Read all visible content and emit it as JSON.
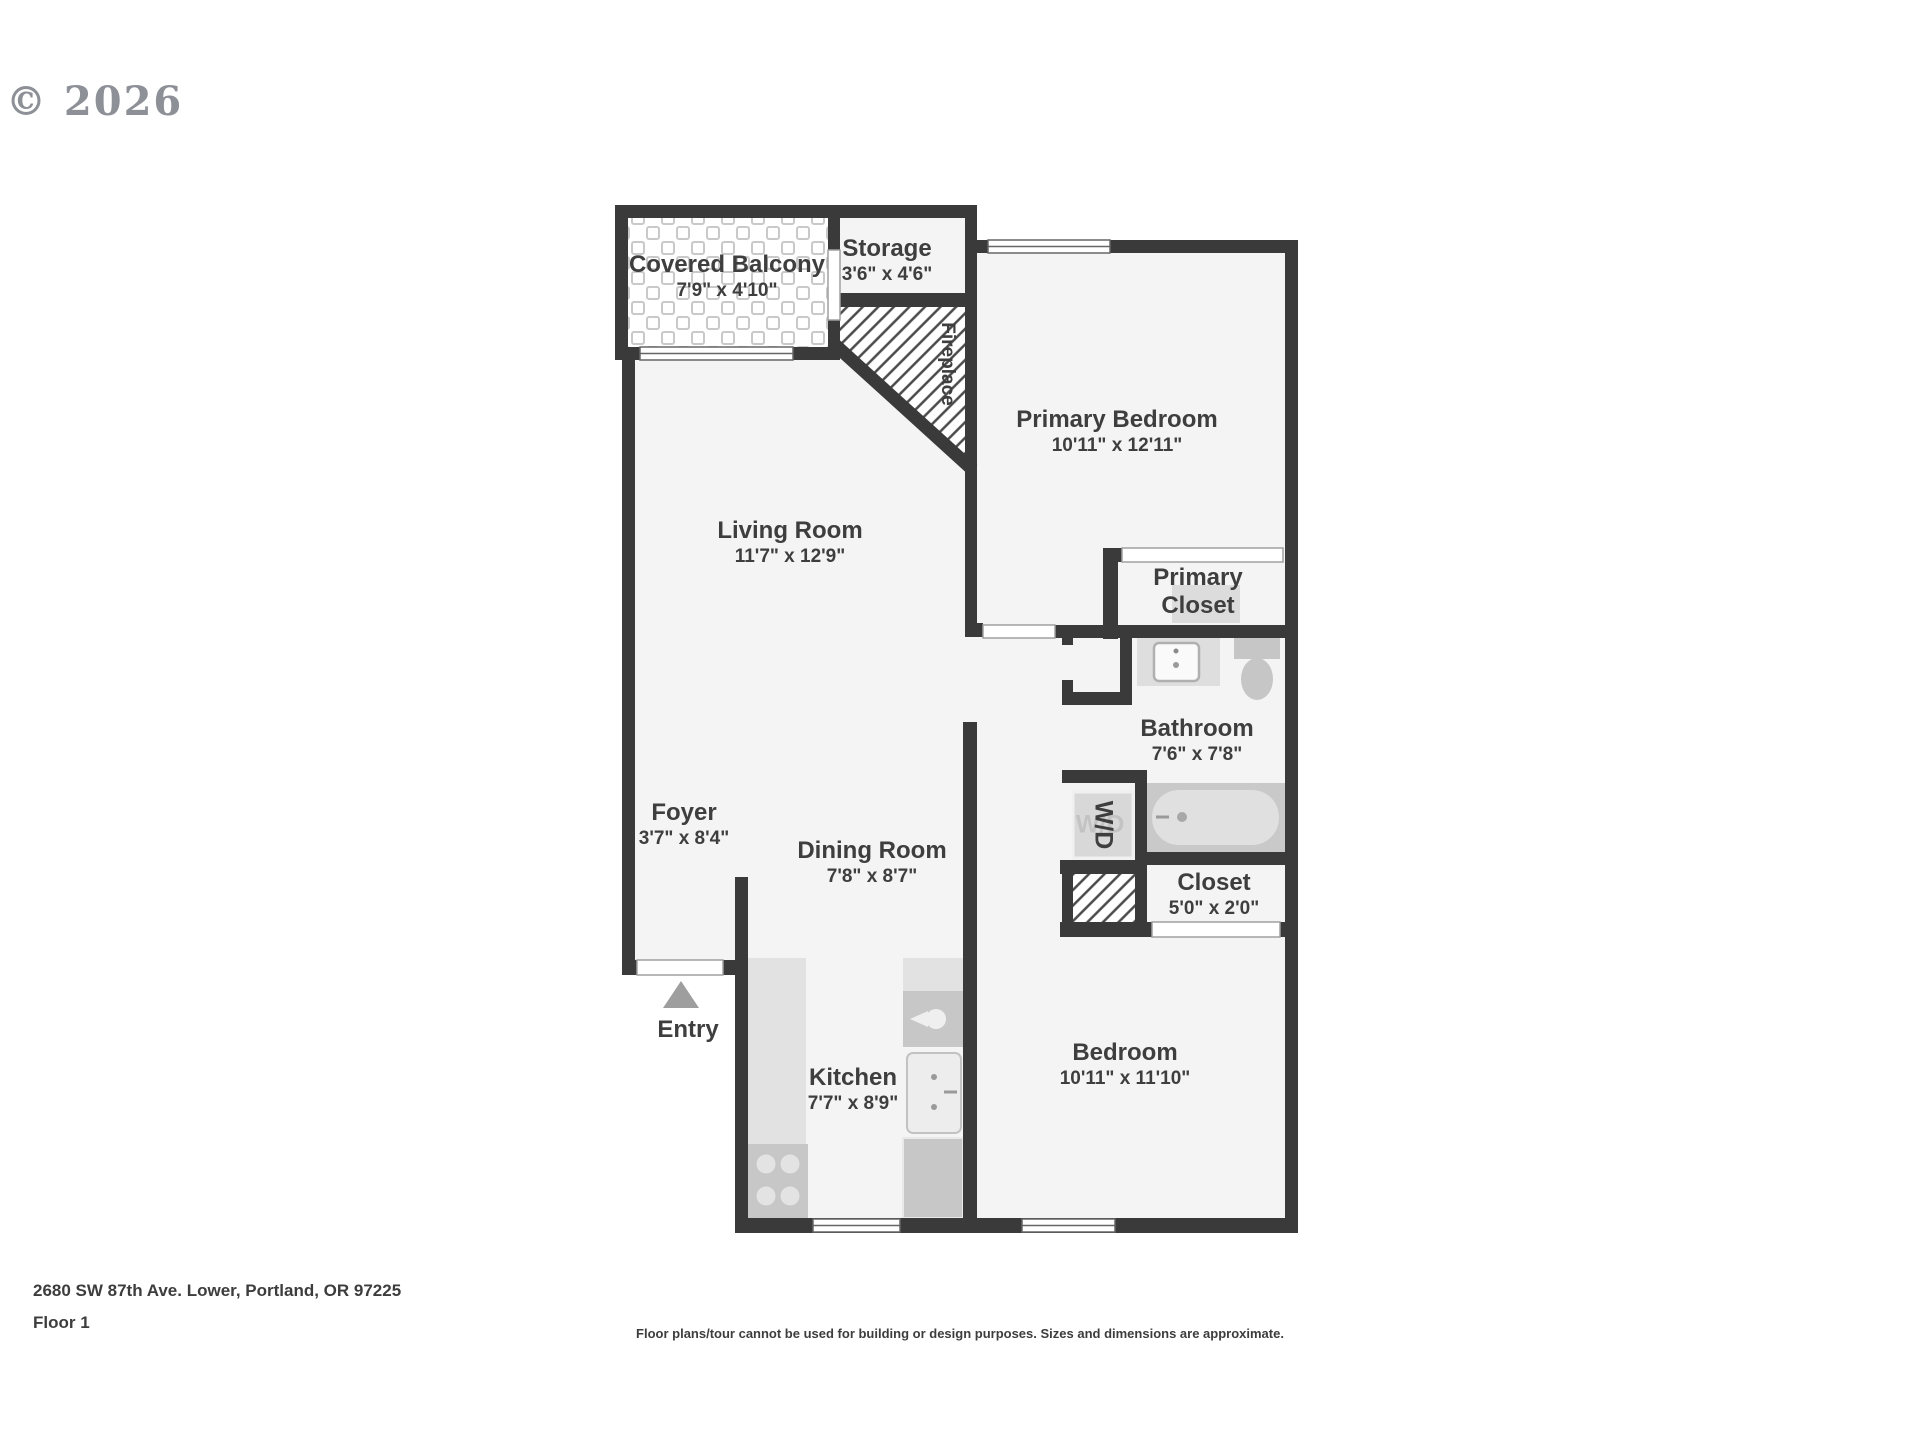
{
  "copyright": "© 2026",
  "footer": {
    "address": "2680 SW 87th Ave. Lower, Portland, OR 97225",
    "floor": "Floor 1",
    "disclaimer": "Floor plans/tour cannot be used for building or design purposes. Sizes and dimensions are approximate."
  },
  "rooms": {
    "covered_balcony": {
      "name": "Covered Balcony",
      "dims": "7'9\" x 4'10\""
    },
    "storage": {
      "name": "Storage",
      "dims": "3'6\" x 4'6\""
    },
    "fireplace": {
      "name": "Fireplace"
    },
    "primary_bedroom": {
      "name": "Primary Bedroom",
      "dims": "10'11\" x 12'11\""
    },
    "living_room": {
      "name": "Living Room",
      "dims": "11'7\" x 12'9\""
    },
    "primary_closet": {
      "name": "Primary Closet"
    },
    "bathroom": {
      "name": "Bathroom",
      "dims": "7'6\" x 7'8\""
    },
    "foyer": {
      "name": "Foyer",
      "dims": "3'7\" x 8'4\""
    },
    "dining_room": {
      "name": "Dining Room",
      "dims": "7'8\" x 8'7\""
    },
    "wd": {
      "name": "W/D"
    },
    "closet": {
      "name": "Closet",
      "dims": "5'0\" x 2'0\""
    },
    "entry": {
      "name": "Entry"
    },
    "kitchen": {
      "name": "Kitchen",
      "dims": "7'7\" x 8'9\""
    },
    "bedroom": {
      "name": "Bedroom",
      "dims": "10'11\" x 11'10\""
    }
  },
  "colors": {
    "wall": "#3a3a3a",
    "floor": "#f4f4f4",
    "counter": "#e2e2e2",
    "appliance": "#c7c7c7",
    "tub_surround": "#c9c9c9",
    "tub_inner": "#e0e0e0",
    "label_text": "#3e3e3e",
    "logo_gray": "#8d9096"
  }
}
